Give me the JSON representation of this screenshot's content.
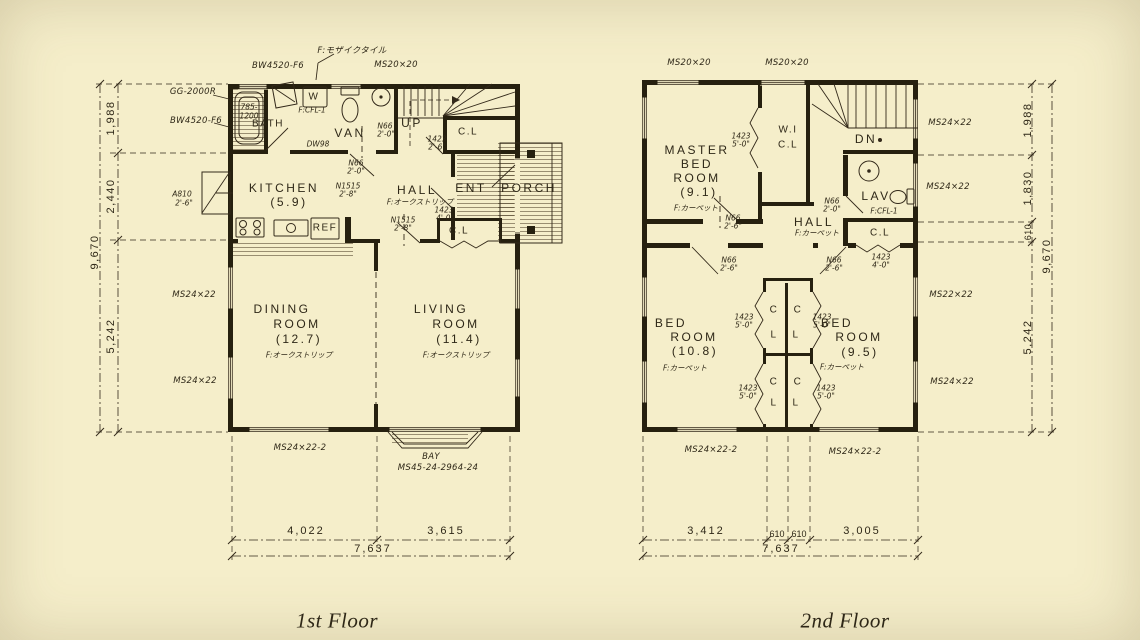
{
  "colors": {
    "paper": "#f5eeca",
    "ink": "#33291a",
    "wall": "#26200f"
  },
  "floors": [
    {
      "title": "1st Floor",
      "labels": [
        {
          "n": "note-floor-mosaic-tile",
          "t": "F:モザイクタイル",
          "x": 352,
          "y": 50,
          "c": "ann"
        },
        {
          "n": "window-label-bw4520-top",
          "t": "BW4520-F6",
          "x": 278,
          "y": 66,
          "c": "ann"
        },
        {
          "n": "window-label-ms20x20",
          "t": "MS20×20",
          "x": 396,
          "y": 65,
          "c": "ann"
        },
        {
          "n": "equip-label-gg2000r",
          "t": "GG-2000R",
          "x": 193,
          "y": 92,
          "c": "ann"
        },
        {
          "n": "window-label-bw4520-left",
          "t": "BW4520-F6",
          "x": 196,
          "y": 121,
          "c": "ann"
        },
        {
          "n": "tub-size-785",
          "t": "785-",
          "x": 249,
          "y": 107,
          "c": "annS"
        },
        {
          "n": "tub-size-1200",
          "t": "1200",
          "x": 249,
          "y": 116,
          "c": "annS"
        },
        {
          "n": "room-label-bath",
          "t": "BATH",
          "x": 268,
          "y": 124,
          "c": "roomSm"
        },
        {
          "n": "washer-label",
          "t": "W",
          "x": 314,
          "y": 97,
          "c": "roomSm"
        },
        {
          "n": "note-floor-cf-van",
          "t": "F:CFL-1",
          "x": 312,
          "y": 110,
          "c": "annS"
        },
        {
          "n": "room-label-van",
          "t": "VAN",
          "x": 350,
          "y": 133,
          "c": "room"
        },
        {
          "n": "note-dw98",
          "t": "DW98",
          "x": 318,
          "y": 144,
          "c": "annS"
        },
        {
          "n": "door-label-n66-van",
          "t": "N66",
          "x": 385,
          "y": 126,
          "c": "annS"
        },
        {
          "n": "door-size-n66-van",
          "t": "2'-0\"",
          "x": 386,
          "y": 134,
          "c": "annS"
        },
        {
          "n": "stairs-label-up",
          "t": "UP",
          "x": 412,
          "y": 123,
          "c": "room"
        },
        {
          "n": "door-label-1423-stair-closet",
          "t": "1423",
          "x": 437,
          "y": 139,
          "c": "annS"
        },
        {
          "n": "door-size-1423-stair-closet",
          "t": "2'-6\"",
          "x": 437,
          "y": 147,
          "c": "annS"
        },
        {
          "n": "closet-label-stairs",
          "t": "C.L",
          "x": 468,
          "y": 132,
          "c": "roomSm"
        },
        {
          "n": "door-label-n66-kitchen",
          "t": "N66",
          "x": 356,
          "y": 163,
          "c": "annS"
        },
        {
          "n": "door-size-n66-kitchen",
          "t": "2'-0\"",
          "x": 356,
          "y": 171,
          "c": "annS"
        },
        {
          "n": "door-label-n1515-kitchen",
          "t": "N1515",
          "x": 348,
          "y": 186,
          "c": "annS"
        },
        {
          "n": "door-size-n1515-kitchen",
          "t": "2'-8\"",
          "x": 348,
          "y": 194,
          "c": "annS"
        },
        {
          "n": "room-label-kitchen",
          "t": "KITCHEN",
          "x": 284,
          "y": 188,
          "c": "room"
        },
        {
          "n": "room-area-kitchen",
          "t": "(5.9)",
          "x": 289,
          "y": 202,
          "c": "room"
        },
        {
          "n": "room-label-hall",
          "t": "HALL",
          "x": 417,
          "y": 190,
          "c": "room"
        },
        {
          "n": "note-floor-hall",
          "t": "F:オークストリップ",
          "x": 420,
          "y": 202,
          "c": "annS"
        },
        {
          "n": "door-label-1423-hall-closet",
          "t": "1423",
          "x": 444,
          "y": 210,
          "c": "annS"
        },
        {
          "n": "door-size-1423-hall-closet",
          "t": "4'-0\"",
          "x": 445,
          "y": 218,
          "c": "annS"
        },
        {
          "n": "door-label-n1515-hall",
          "t": "N1515",
          "x": 403,
          "y": 220,
          "c": "annS"
        },
        {
          "n": "door-size-n1515-hall",
          "t": "2'-8\"",
          "x": 403,
          "y": 228,
          "c": "annS"
        },
        {
          "n": "room-label-ent",
          "t": "ENT",
          "x": 471,
          "y": 188,
          "c": "room"
        },
        {
          "n": "room-label-porch",
          "t": "PORCH",
          "x": 529,
          "y": 188,
          "c": "room"
        },
        {
          "n": "closet-label-ent",
          "t": "C.L",
          "x": 459,
          "y": 231,
          "c": "roomSm"
        },
        {
          "n": "appliance-label-ref",
          "t": "REF",
          "x": 325,
          "y": 228,
          "c": "roomSm"
        },
        {
          "n": "room-label-dining",
          "t": "DINING",
          "x": 282,
          "y": 309,
          "c": "room"
        },
        {
          "n": "room-label-dining2",
          "t": "ROOM",
          "x": 297,
          "y": 324,
          "c": "room"
        },
        {
          "n": "room-area-dining",
          "t": "(12.7)",
          "x": 299,
          "y": 339,
          "c": "room"
        },
        {
          "n": "note-floor-dining",
          "t": "F:オークストリップ",
          "x": 299,
          "y": 355,
          "c": "annS"
        },
        {
          "n": "room-label-living",
          "t": "LIVING",
          "x": 441,
          "y": 309,
          "c": "room"
        },
        {
          "n": "room-label-living2",
          "t": "ROOM",
          "x": 456,
          "y": 324,
          "c": "room"
        },
        {
          "n": "room-area-living",
          "t": "(11.4)",
          "x": 459,
          "y": 339,
          "c": "room"
        },
        {
          "n": "note-floor-living",
          "t": "F:オークストリップ",
          "x": 456,
          "y": 355,
          "c": "annS"
        },
        {
          "n": "vent-label-a810",
          "t": "A810",
          "x": 182,
          "y": 194,
          "c": "annS"
        },
        {
          "n": "vent-size-a810",
          "t": "2'-6\"",
          "x": 184,
          "y": 203,
          "c": "annS"
        },
        {
          "n": "window-label-ms24-left1",
          "t": "MS24×22",
          "x": 194,
          "y": 295,
          "c": "ann"
        },
        {
          "n": "window-label-ms24-left2",
          "t": "MS24×22",
          "x": 195,
          "y": 381,
          "c": "ann"
        },
        {
          "n": "window-label-ms24-bottom",
          "t": "MS24×22-2",
          "x": 300,
          "y": 448,
          "c": "ann"
        },
        {
          "n": "bay-label",
          "t": "BAY",
          "x": 431,
          "y": 457,
          "c": "ann"
        },
        {
          "n": "bay-spec-label",
          "t": "MS45-24-2964-24",
          "x": 438,
          "y": 468,
          "c": "ann"
        },
        {
          "n": "dim-left-1988",
          "t": "1,988",
          "x": 111,
          "y": 118,
          "c": "dimv"
        },
        {
          "n": "dim-left-2440",
          "t": "2,440",
          "x": 111,
          "y": 196,
          "c": "dimv"
        },
        {
          "n": "dim-left-5242",
          "t": "5,242",
          "x": 111,
          "y": 336,
          "c": "dimv"
        },
        {
          "n": "dim-left-9670",
          "t": "9,670",
          "x": 95,
          "y": 252,
          "c": "dimv"
        },
        {
          "n": "dim-bottom-4022",
          "t": "4,022",
          "x": 306,
          "y": 531,
          "c": "dim"
        },
        {
          "n": "dim-bottom-3615",
          "t": "3,615",
          "x": 446,
          "y": 531,
          "c": "dim"
        },
        {
          "n": "dim-bottom-7637",
          "t": "7,637",
          "x": 373,
          "y": 549,
          "c": "dim"
        }
      ]
    },
    {
      "title": "2nd Floor",
      "labels": [
        {
          "n": "window-label-ms20-a",
          "t": "MS20×20",
          "x": 689,
          "y": 63,
          "c": "ann"
        },
        {
          "n": "window-label-ms20-b",
          "t": "MS20×20",
          "x": 787,
          "y": 63,
          "c": "ann"
        },
        {
          "n": "room-label-master1",
          "t": "MASTER",
          "x": 697,
          "y": 150,
          "c": "room"
        },
        {
          "n": "room-label-master2",
          "t": "BED",
          "x": 697,
          "y": 164,
          "c": "room"
        },
        {
          "n": "room-label-master3",
          "t": "ROOM",
          "x": 697,
          "y": 178,
          "c": "room"
        },
        {
          "n": "room-area-master",
          "t": "(9.1)",
          "x": 699,
          "y": 192,
          "c": "room"
        },
        {
          "n": "note-floor-master",
          "t": "F:カーペット",
          "x": 696,
          "y": 208,
          "c": "annS"
        },
        {
          "n": "door-label-1423-wicl",
          "t": "1423",
          "x": 741,
          "y": 136,
          "c": "annS"
        },
        {
          "n": "door-size-1423-wicl",
          "t": "5'-0\"",
          "x": 741,
          "y": 144,
          "c": "annS"
        },
        {
          "n": "closet-label-wi",
          "t": "W.I",
          "x": 788,
          "y": 130,
          "c": "roomSm"
        },
        {
          "n": "closet-label-wicl",
          "t": "C.L",
          "x": 788,
          "y": 145,
          "c": "roomSm"
        },
        {
          "n": "stairs-label-dn",
          "t": "DN",
          "x": 866,
          "y": 139,
          "c": "room"
        },
        {
          "n": "room-label-lav",
          "t": "LAV",
          "x": 876,
          "y": 196,
          "c": "room"
        },
        {
          "n": "note-floor-lav",
          "t": "F:CFL-1",
          "x": 884,
          "y": 211,
          "c": "annS"
        },
        {
          "n": "door-label-n66-lav",
          "t": "N66",
          "x": 832,
          "y": 201,
          "c": "annS"
        },
        {
          "n": "door-size-n66-lav",
          "t": "2'-0\"",
          "x": 832,
          "y": 209,
          "c": "annS"
        },
        {
          "n": "room-label-hall2",
          "t": "HALL",
          "x": 814,
          "y": 222,
          "c": "room"
        },
        {
          "n": "note-floor-hall2",
          "t": "F:カーペット",
          "x": 817,
          "y": 233,
          "c": "annS"
        },
        {
          "n": "closet-label-lav",
          "t": "C.L",
          "x": 880,
          "y": 233,
          "c": "roomSm"
        },
        {
          "n": "door-label-1423-lavcl",
          "t": "1423",
          "x": 881,
          "y": 257,
          "c": "annS"
        },
        {
          "n": "door-size-1423-lavcl",
          "t": "4'-0\"",
          "x": 881,
          "y": 265,
          "c": "annS"
        },
        {
          "n": "door-label-n66-master",
          "t": "N66",
          "x": 733,
          "y": 218,
          "c": "annS"
        },
        {
          "n": "door-size-n66-master",
          "t": "2'-6\"",
          "x": 733,
          "y": 226,
          "c": "annS"
        },
        {
          "n": "door-label-n66-bed108",
          "t": "N66",
          "x": 729,
          "y": 260,
          "c": "annS"
        },
        {
          "n": "door-size-n66-bed108",
          "t": "2'-6\"",
          "x": 729,
          "y": 268,
          "c": "annS"
        },
        {
          "n": "door-label-n66-bed95",
          "t": "N66",
          "x": 834,
          "y": 260,
          "c": "annS"
        },
        {
          "n": "door-size-n66-bed95",
          "t": "2'-6\"",
          "x": 834,
          "y": 268,
          "c": "annS"
        },
        {
          "n": "room-label-bed108-1",
          "t": "BED",
          "x": 671,
          "y": 323,
          "c": "room"
        },
        {
          "n": "room-label-bed108-2",
          "t": "ROOM",
          "x": 694,
          "y": 337,
          "c": "room"
        },
        {
          "n": "room-area-bed108",
          "t": "(10.8)",
          "x": 695,
          "y": 351,
          "c": "room"
        },
        {
          "n": "note-floor-bed108",
          "t": "F:カーペット",
          "x": 685,
          "y": 368,
          "c": "annS"
        },
        {
          "n": "room-label-bed95-1",
          "t": "BED",
          "x": 837,
          "y": 323,
          "c": "room"
        },
        {
          "n": "room-label-bed95-2",
          "t": "ROOM",
          "x": 859,
          "y": 337,
          "c": "room"
        },
        {
          "n": "room-area-bed95",
          "t": "(9.5)",
          "x": 860,
          "y": 352,
          "c": "room"
        },
        {
          "n": "note-floor-bed95",
          "t": "F:カーペット",
          "x": 842,
          "y": 367,
          "c": "annS"
        },
        {
          "n": "closet-letter-c1",
          "t": "C",
          "x": 774,
          "y": 310,
          "c": "roomSm"
        },
        {
          "n": "closet-letter-c2",
          "t": "C",
          "x": 798,
          "y": 310,
          "c": "roomSm"
        },
        {
          "n": "closet-letter-l1",
          "t": "L",
          "x": 774,
          "y": 335,
          "c": "roomSm"
        },
        {
          "n": "closet-letter-l2",
          "t": "L",
          "x": 796,
          "y": 335,
          "c": "roomSm"
        },
        {
          "n": "closet-letter-c3",
          "t": "C",
          "x": 774,
          "y": 382,
          "c": "roomSm"
        },
        {
          "n": "closet-letter-c4",
          "t": "C",
          "x": 798,
          "y": 382,
          "c": "roomSm"
        },
        {
          "n": "closet-letter-l3",
          "t": "L",
          "x": 774,
          "y": 403,
          "c": "roomSm"
        },
        {
          "n": "closet-letter-l4",
          "t": "L",
          "x": 796,
          "y": 403,
          "c": "roomSm"
        },
        {
          "n": "closet-door-1423-a",
          "t": "1423",
          "x": 744,
          "y": 317,
          "c": "annS"
        },
        {
          "n": "closet-door-size-a",
          "t": "5'-0\"",
          "x": 744,
          "y": 325,
          "c": "annS"
        },
        {
          "n": "closet-door-1423-b",
          "t": "1423",
          "x": 822,
          "y": 317,
          "c": "annS"
        },
        {
          "n": "closet-door-size-b",
          "t": "5'-0\"",
          "x": 822,
          "y": 325,
          "c": "annS"
        },
        {
          "n": "closet-door-1423-c",
          "t": "1423",
          "x": 748,
          "y": 388,
          "c": "annS"
        },
        {
          "n": "closet-door-size-c",
          "t": "5'-0\"",
          "x": 748,
          "y": 396,
          "c": "annS"
        },
        {
          "n": "closet-door-1423-d",
          "t": "1423",
          "x": 826,
          "y": 388,
          "c": "annS"
        },
        {
          "n": "closet-door-size-d",
          "t": "5'-0\"",
          "x": 826,
          "y": 396,
          "c": "annS"
        },
        {
          "n": "window-label-ms24-r1",
          "t": "MS24×22",
          "x": 950,
          "y": 123,
          "c": "ann"
        },
        {
          "n": "window-label-ms24-r2",
          "t": "MS24×22",
          "x": 948,
          "y": 187,
          "c": "ann"
        },
        {
          "n": "window-label-ms22-r3",
          "t": "MS22×22",
          "x": 951,
          "y": 295,
          "c": "ann"
        },
        {
          "n": "window-label-ms24-r4",
          "t": "MS24×22",
          "x": 952,
          "y": 382,
          "c": "ann"
        },
        {
          "n": "window-label-ms24-b1",
          "t": "MS24×22-2",
          "x": 711,
          "y": 450,
          "c": "ann"
        },
        {
          "n": "window-label-ms24-b2",
          "t": "MS24×22-2",
          "x": 855,
          "y": 452,
          "c": "ann"
        },
        {
          "n": "dim-right-1988",
          "t": "1,988",
          "x": 1028,
          "y": 120,
          "c": "dimv"
        },
        {
          "n": "dim-right-1830",
          "t": "1,830",
          "x": 1028,
          "y": 188,
          "c": "dimv"
        },
        {
          "n": "dim-right-610",
          "t": "610",
          "x": 1028,
          "y": 232,
          "c": "dimvS"
        },
        {
          "n": "dim-right-5242",
          "t": "5,242",
          "x": 1028,
          "y": 337,
          "c": "dimv"
        },
        {
          "n": "dim-right-9670",
          "t": "9,670",
          "x": 1047,
          "y": 256,
          "c": "dimv"
        },
        {
          "n": "dim-bottom-3412",
          "t": "3,412",
          "x": 706,
          "y": 531,
          "c": "dim"
        },
        {
          "n": "dim-bottom-610a",
          "t": "610",
          "x": 777,
          "y": 534,
          "c": "dimS"
        },
        {
          "n": "dim-bottom-610b",
          "t": "610",
          "x": 799,
          "y": 534,
          "c": "dimS"
        },
        {
          "n": "dim-bottom-3005",
          "t": "3,005",
          "x": 862,
          "y": 531,
          "c": "dim"
        },
        {
          "n": "dim-bottom-7637",
          "t": "7,637",
          "x": 781,
          "y": 549,
          "c": "dim"
        }
      ]
    }
  ]
}
